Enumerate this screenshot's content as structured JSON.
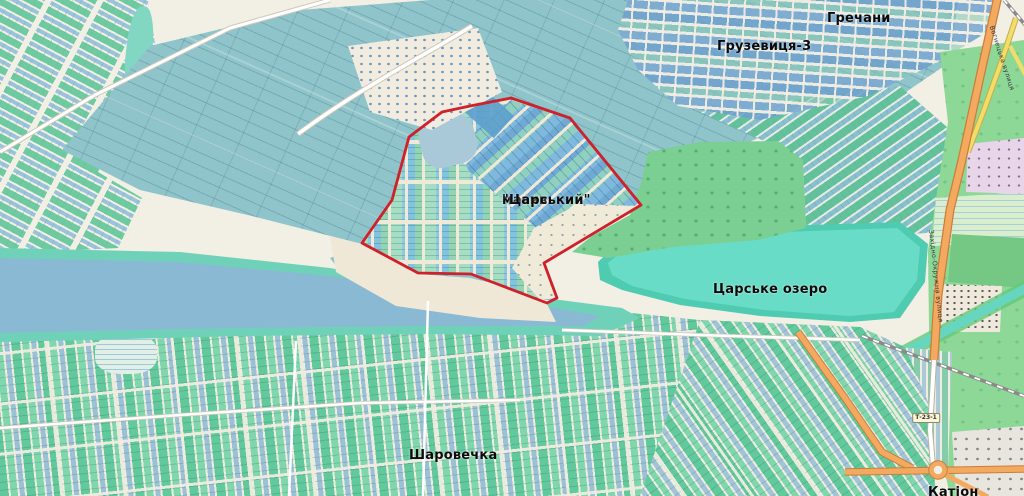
{
  "map": {
    "place_labels": [
      {
        "name": "grechany",
        "lines": [
          "Гречани"
        ],
        "x": 827,
        "y": 12,
        "font_size": 13
      },
      {
        "name": "gruzevytsia-3",
        "lines": [
          "Грузевиця-3"
        ],
        "x": 717,
        "y": 40,
        "font_size": 13
      },
      {
        "name": "masyv-tsarskyi",
        "lines": [
          "масив",
          "\"Царський\""
        ],
        "x": 502,
        "y": 194,
        "font_size": 13
      },
      {
        "name": "tsarske-ozero",
        "lines": [
          "Царське озеро"
        ],
        "x": 713,
        "y": 283,
        "font_size": 13
      },
      {
        "name": "sharovechka",
        "lines": [
          "Шаровечка"
        ],
        "x": 409,
        "y": 449,
        "font_size": 13
      },
      {
        "name": "kation",
        "lines": [
          "Катіон"
        ],
        "x": 928,
        "y": 486,
        "font_size": 13
      }
    ],
    "road_labels": [
      {
        "name": "zakhidno-okruzhna",
        "text": "Західно-Окружна вулиця",
        "x": 936,
        "y": 276,
        "rotation": 84
      },
      {
        "name": "vohnetska",
        "text": "Вогнецька вулиця",
        "x": 1002,
        "y": 58,
        "rotation": 72
      }
    ],
    "road_shield": {
      "text": "Т-23-1",
      "x": 926,
      "y": 418
    },
    "boundary": {
      "name": "масив \"Царський\"",
      "color": "#ce2129",
      "stroke_width": 2.8,
      "points": [
        [
          511,
          98
        ],
        [
          570,
          118
        ],
        [
          641,
          205
        ],
        [
          544,
          263
        ],
        [
          557,
          298
        ],
        [
          547,
          303
        ],
        [
          471,
          274
        ],
        [
          418,
          273
        ],
        [
          362,
          243
        ],
        [
          392,
          200
        ],
        [
          409,
          137
        ],
        [
          442,
          112
        ],
        [
          470,
          106
        ]
      ]
    },
    "colors": {
      "background": "#f2efe4",
      "fields_teal": "#8fc4cb",
      "water_left": "#8ab9d3",
      "lake": "#68dcc6",
      "shore_green": "#6fd2b8",
      "scrub_green": "#7bcf92",
      "parcel_green": "#5fc99b",
      "parcel_blue": "#7eb6da",
      "trunk_road_orange": "#f4a960",
      "boundary_red": "#ce2129"
    }
  }
}
